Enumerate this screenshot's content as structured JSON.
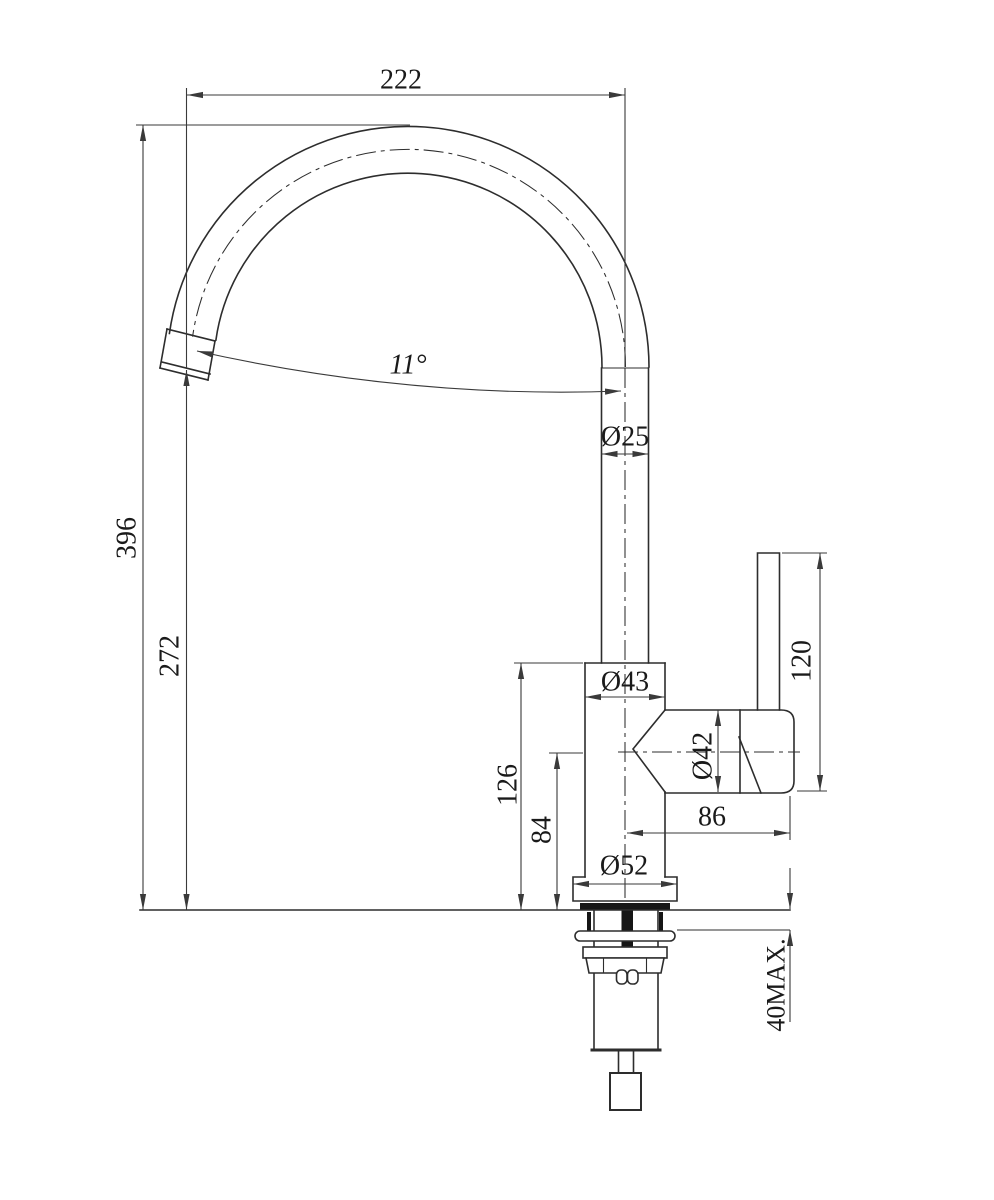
{
  "drawing": {
    "kind": "faucet-dimension-diagram",
    "colors": {
      "background": "#ffffff",
      "line": "#2d2d2d",
      "dimension_line": "#3a3a3a",
      "text": "#1a1a1a"
    },
    "dimensions": {
      "spout_reach": "222",
      "spout_angle": "11°",
      "spout_tube_diameter": "Ø25",
      "total_height": "396",
      "outlet_height": "272",
      "body_diameter": "Ø43",
      "cartridge_diameter": "Ø42",
      "handle_height": "120",
      "body_height": "126",
      "side_axis_height": "84",
      "handle_reach": "86",
      "base_diameter": "Ø52",
      "max_deck_thickness": "40MAX."
    }
  }
}
